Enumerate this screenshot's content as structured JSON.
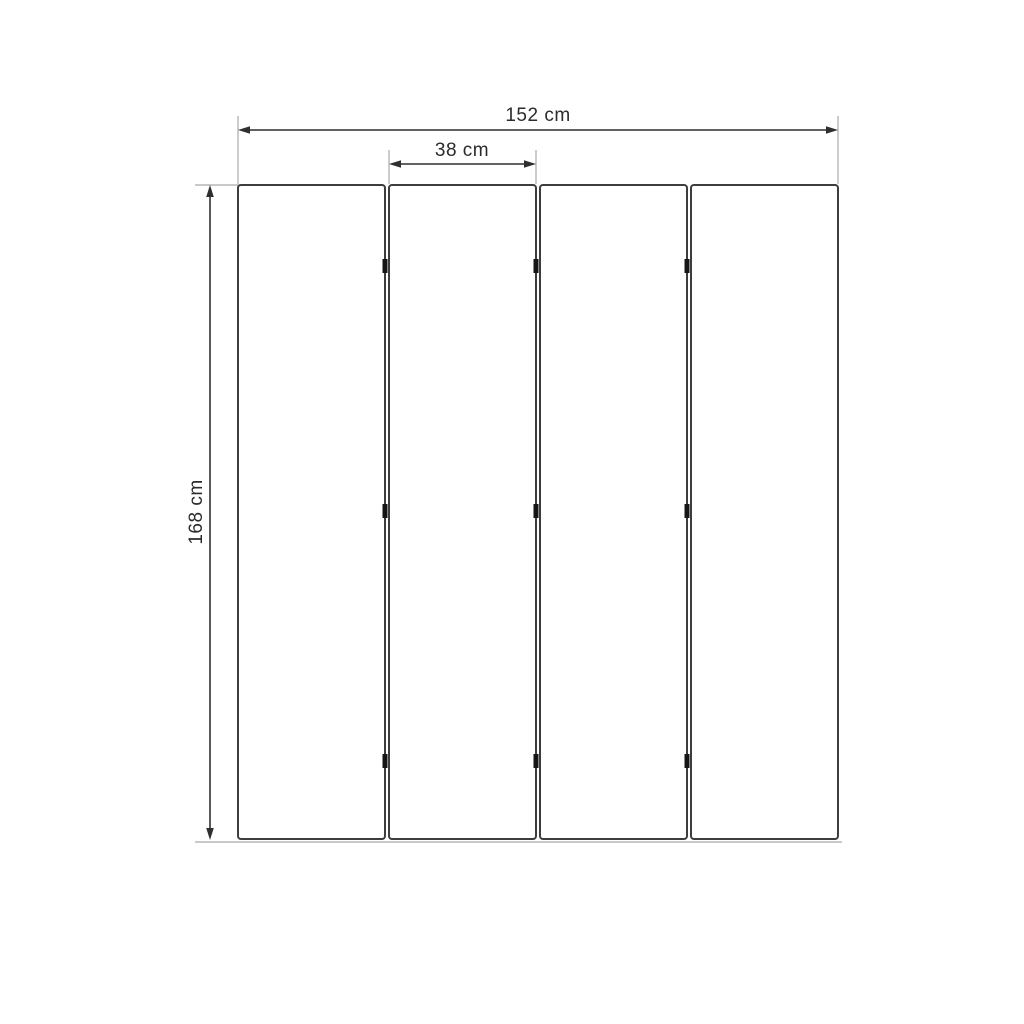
{
  "page": {
    "background": "#ffffff",
    "title": "4-panel folding screen dimension drawing"
  },
  "diagram": {
    "type": "dimensioned-drawing",
    "subject": "four-panel folding screen, front view",
    "panel_count": 4,
    "hinge_rows": 3,
    "dimensions": {
      "total_width": {
        "label": "152 cm",
        "value": 152,
        "unit": "cm",
        "orientation": "horizontal"
      },
      "panel_width": {
        "label": "38 cm",
        "value": 38,
        "unit": "cm",
        "orientation": "horizontal"
      },
      "height": {
        "label": "168 cm",
        "value": 168,
        "unit": "cm",
        "orientation": "vertical"
      }
    },
    "colors": {
      "panel_stroke": "#3d3d3d",
      "panel_fill": "#ffffff",
      "dimension_line": "#2f2f2f",
      "extension_line": "#a9a9a9",
      "hinge": "#161616",
      "text": "#2b2b2b",
      "background": "#ffffff"
    }
  }
}
